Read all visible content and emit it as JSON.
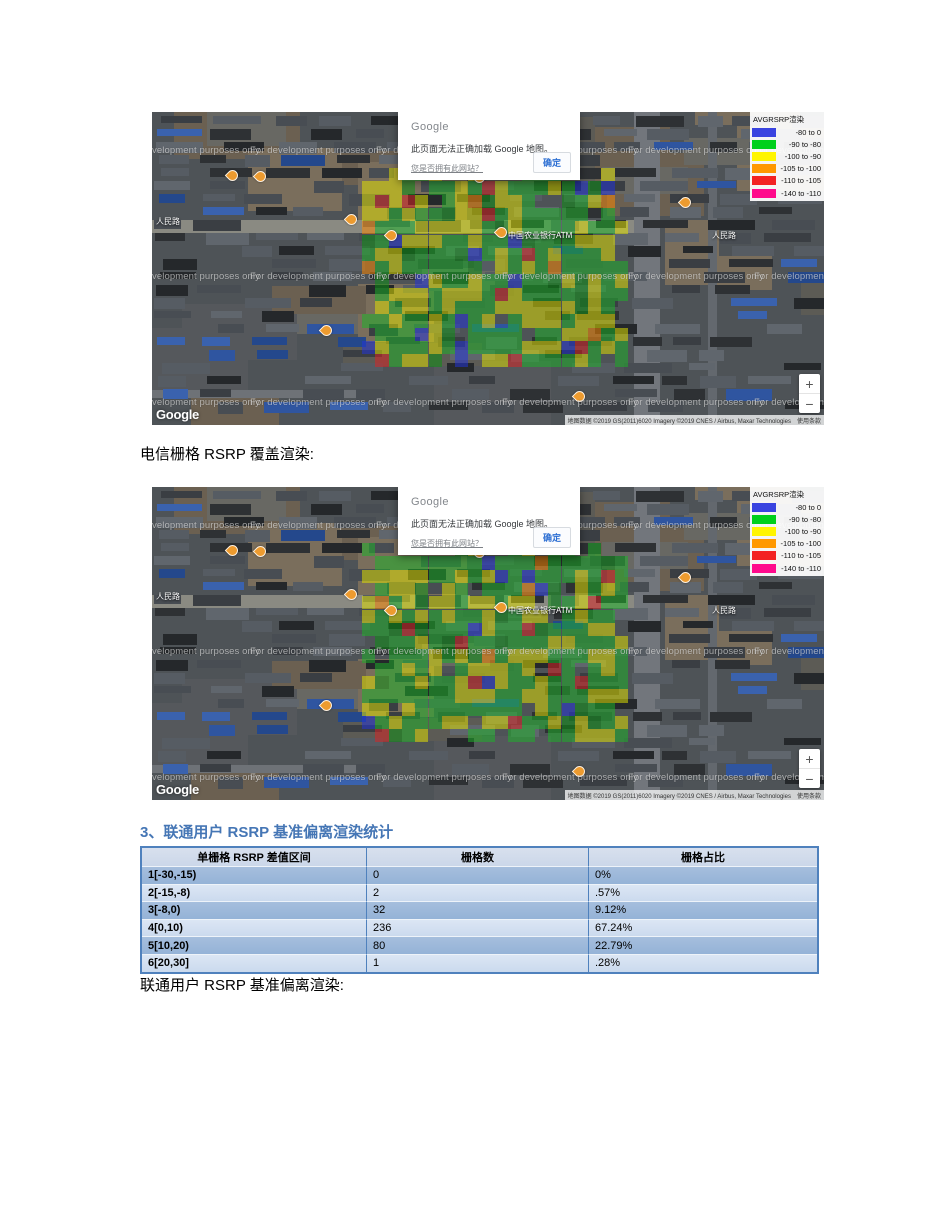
{
  "captions": {
    "map1_caption": "电信栅格 RSRP 覆盖渲染:",
    "section_heading": "3、联通用户 RSRP 基准偏离渲染统计",
    "map2_caption": "联通用户 RSRP 基准偏离渲染:"
  },
  "map_common": {
    "dialog": {
      "brand": "Google",
      "message": "此页面无法正确加载 Google 地图。",
      "link": "您是否拥有此网站？",
      "button": "确定"
    },
    "legend": {
      "title": "AVGRSRP渲染",
      "entries": [
        {
          "color": "#3a44e0",
          "label": "-80 to 0"
        },
        {
          "color": "#00d01c",
          "label": "-90 to -80"
        },
        {
          "color": "#fff500",
          "label": "-100 to -90"
        },
        {
          "color": "#ff9800",
          "label": "-105 to -100"
        },
        {
          "color": "#f32222",
          "label": "-110 to -105"
        },
        {
          "color": "#ff0a8c",
          "label": "-140 to -110"
        }
      ]
    },
    "watermark": "For development purposes only",
    "logo": "Google",
    "attribution": "地图数据 ©2019 GS(2011)6020 Imagery ©2019 CNES / Airbus, Maxar Technologies",
    "terms": "使用条款",
    "zoom_in": "+",
    "zoom_out": "−",
    "labels": [
      {
        "text": "人民路",
        "x": 4,
        "y": 104,
        "pin": false
      },
      {
        "text": "中国农业银行ATM",
        "x": 356,
        "y": 118,
        "pin": true
      },
      {
        "text": "人民路",
        "x": 560,
        "y": 118,
        "pin": false
      }
    ]
  },
  "table": {
    "headers": [
      "单栅格 RSRP 差值区间",
      "栅格数",
      "栅格占比"
    ],
    "rows": [
      [
        "1[-30,-15)",
        "0",
        "0%"
      ],
      [
        "2[-15,-8)",
        "2",
        ".57%"
      ],
      [
        "3[-8,0)",
        "32",
        "9.12%"
      ],
      [
        "4[0,10)",
        "236",
        "67.24%"
      ],
      [
        "5[10,20)",
        "80",
        "22.79%"
      ],
      [
        "6[20,30]",
        "1",
        ".28%"
      ]
    ]
  },
  "map_render": {
    "sat_seed": 42,
    "base": "#4e5357",
    "ground": [
      "#6b6051",
      "#7a6e5c",
      "#5c5b55",
      "#686863",
      "#55585c"
    ],
    "buildings": [
      "#2e3134",
      "#3a3e43",
      "#484d53",
      "#565c63",
      "#25282b",
      "#60666d"
    ],
    "blue_roofs": [
      "#2f55a0",
      "#3a62ae",
      "#24488c"
    ],
    "blue_zones": [
      {
        "x": 0,
        "y": 200,
        "w": 190,
        "h": 110
      },
      {
        "x": 575,
        "y": 140,
        "w": 97,
        "h": 130
      }
    ],
    "roads": [
      {
        "x": 0,
        "y": 108,
        "w": 508,
        "h": 13,
        "c": "#8a8a82"
      },
      {
        "x": 482,
        "y": 0,
        "w": 26,
        "h": 313,
        "c": "#72767c"
      },
      {
        "x": 556,
        "y": 0,
        "w": 9,
        "h": 313,
        "c": "#63686e"
      },
      {
        "x": 0,
        "y": 278,
        "w": 213,
        "h": 8,
        "c": "#6e7277"
      }
    ],
    "grid": {
      "x": 210,
      "y": 56,
      "cell": 13.3,
      "cols": 20,
      "rows": 15
    },
    "overlay_colors": {
      "green": "#1db428",
      "dark_green": "#0a9212",
      "yellow": "#e3e300",
      "blue": "#2233dd",
      "red": "#dd2222",
      "orange": "#ff8800"
    },
    "wm_rows": [
      33,
      159,
      285
    ],
    "wm_cols": [
      -28,
      98,
      224,
      350,
      476,
      602
    ]
  }
}
